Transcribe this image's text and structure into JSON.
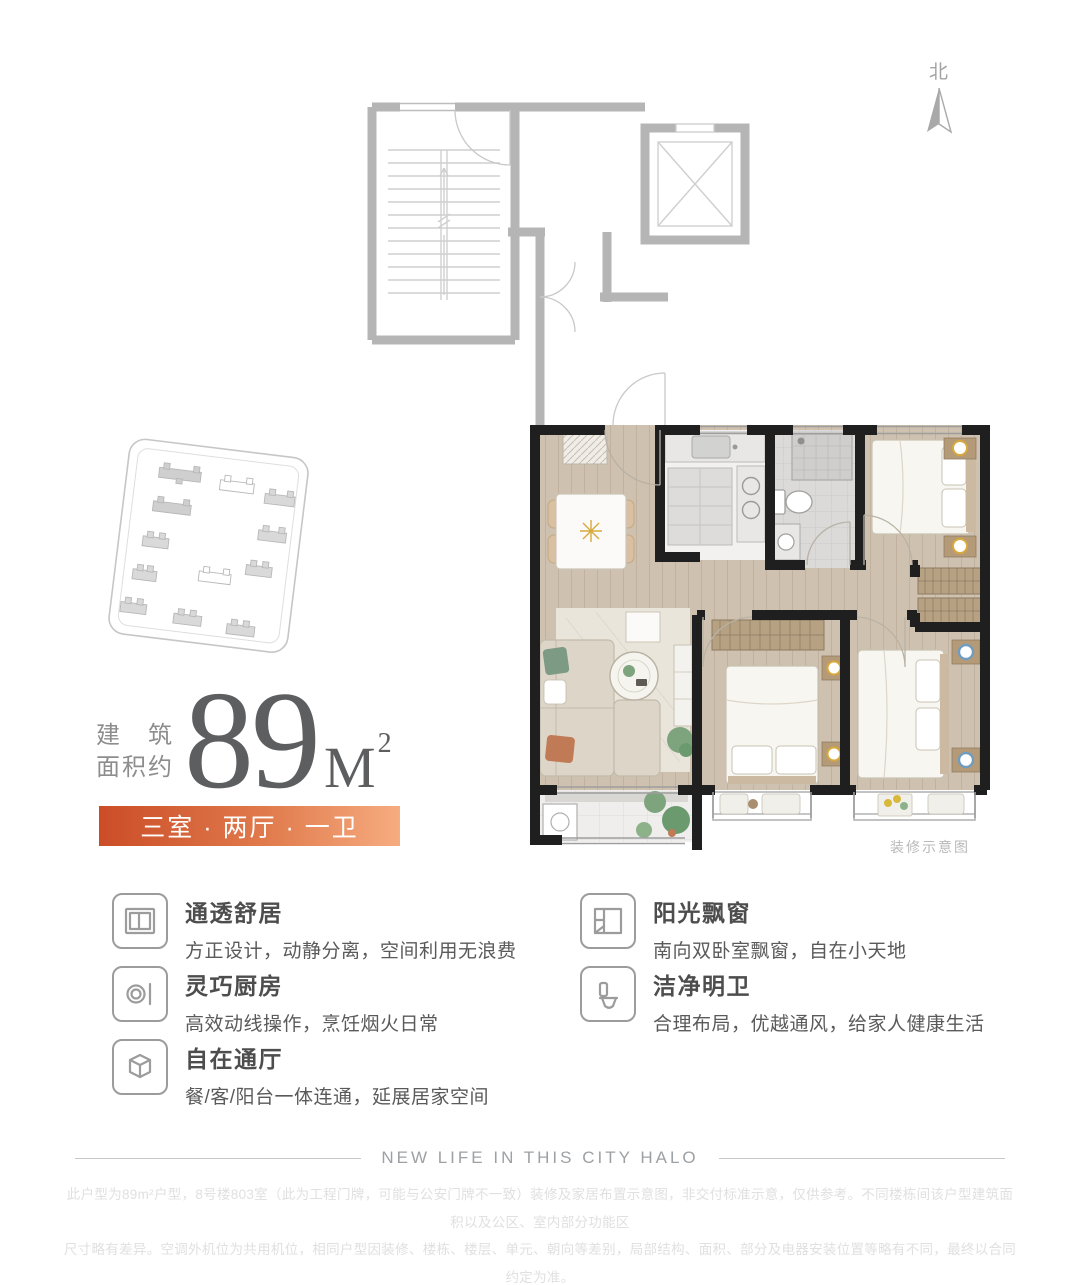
{
  "compass": {
    "label": "北"
  },
  "floor_plan": {
    "caption": "装修示意图"
  },
  "area": {
    "label_line1": "建筑",
    "label_line2": "面积约",
    "value": "89",
    "unit": "M",
    "unit_exp": "2"
  },
  "banner": {
    "text": "三室 · 两厅 · 一卫"
  },
  "features": {
    "left": [
      {
        "icon": "window-icon",
        "title": "通透舒居",
        "desc": "方正设计，动静分离，空间利用无浪费"
      },
      {
        "icon": "kitchen-icon",
        "title": "灵巧厨房",
        "desc": "高效动线操作，烹饪烟火日常"
      },
      {
        "icon": "cube-icon",
        "title": "自在通厅",
        "desc": "餐/客/阳台一体连通，延展居家空间"
      }
    ],
    "right": [
      {
        "icon": "bay-window-icon",
        "title": "阳光飘窗",
        "desc": "南向双卧室飘窗，自在小天地"
      },
      {
        "icon": "toilet-icon",
        "title": "洁净明卫",
        "desc": "合理布局，优越通风，给家人健康生活"
      }
    ]
  },
  "footer": {
    "slogan": "NEW LIFE IN THIS CITY HALO",
    "disclaimer_line1": "此户型为89m²户型，8号楼803室（此为工程门牌，可能与公安门牌不一致）装修及家居布置示意图，非交付标准示意，仅供参考。不同楼栋间该户型建筑面积以及公区、室内部分功能区",
    "disclaimer_line2": "尺寸略有差异。空调外机位为共用机位，相同户型因装修、楼栋、楼层、单元、朝向等差别，局部结构、面积、部分及电器安装位置等略有不同，最终以合同约定为准。"
  },
  "colors": {
    "accent_gradient_start": "#cb4d27",
    "accent_gradient_end": "#f6ac80",
    "unit_wall": "#1f1f1f",
    "common_wall": "#b5b5b5",
    "wood_floor": "#cfc1af"
  }
}
